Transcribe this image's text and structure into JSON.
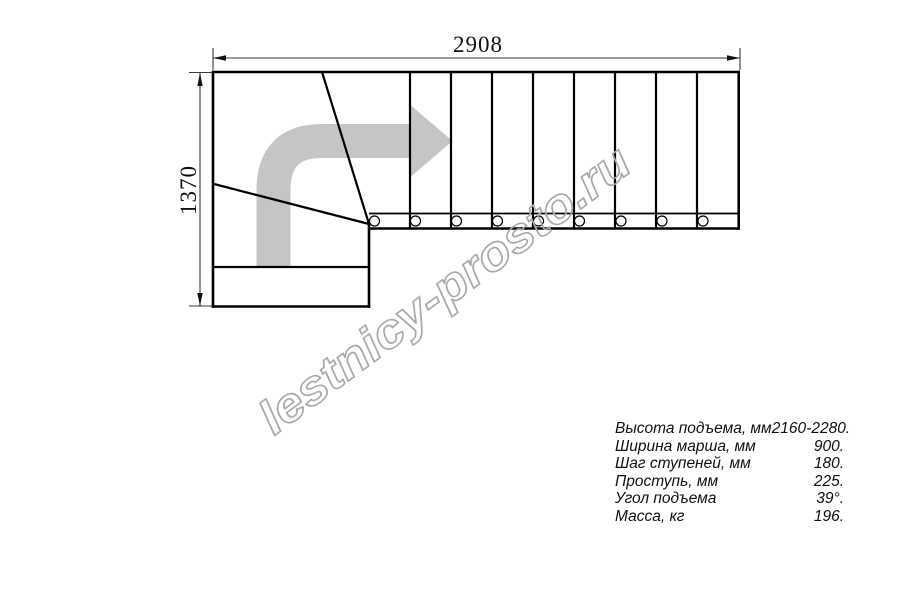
{
  "dimensions": {
    "width_mm": "2908",
    "height_mm": "1370"
  },
  "watermark": {
    "text": "lestnicy-prosto.ru"
  },
  "colors": {
    "arrow": "#c5c5c5",
    "watermark_outline": "#a9a9a9",
    "line": "#000000",
    "dim_line": "#3a3a3a"
  },
  "specs": {
    "rows": [
      {
        "label": "Высота подъема, мм",
        "value": "2160-2280."
      },
      {
        "label": "Ширина марша, мм",
        "value": "900."
      },
      {
        "label": "Шаг ступеней, мм",
        "value": "180."
      },
      {
        "label": "Проступь, мм",
        "value": "225."
      },
      {
        "label": "Угол подъема",
        "value": "39°."
      },
      {
        "label": "Масса, кг",
        "value": "196."
      }
    ]
  }
}
